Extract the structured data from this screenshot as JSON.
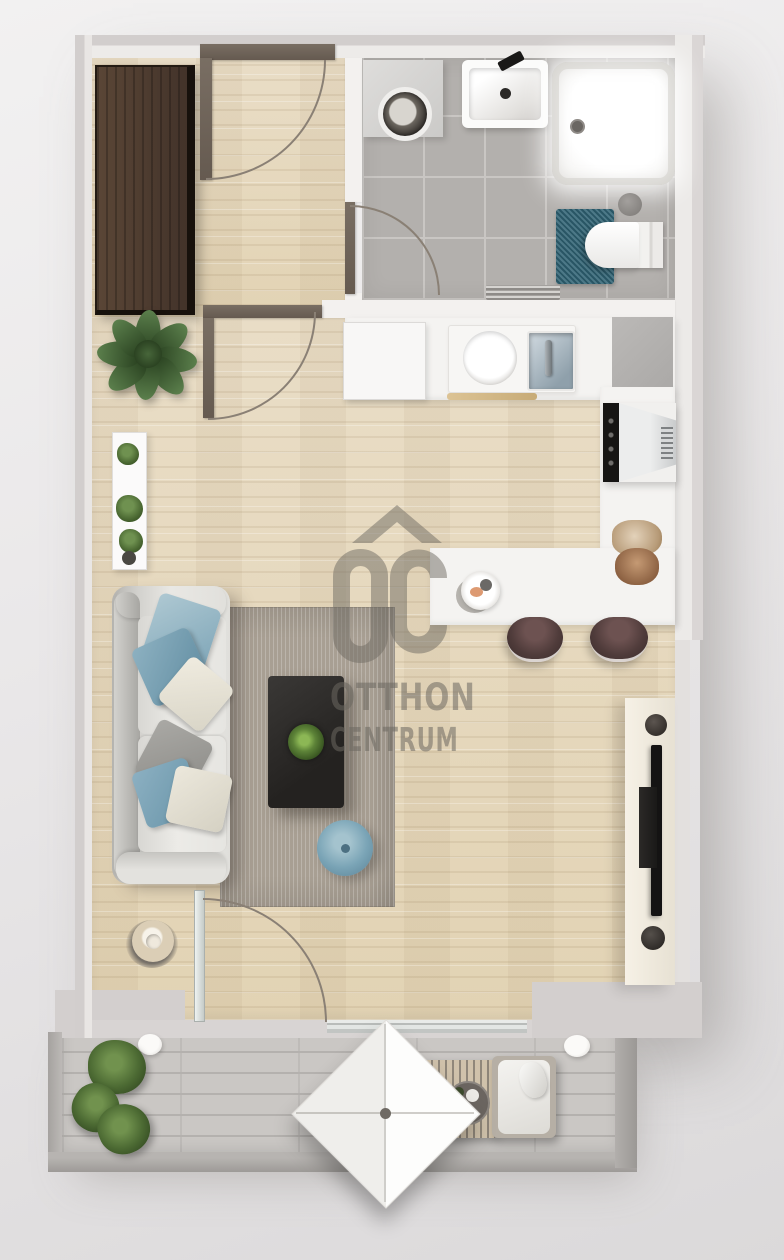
{
  "watermark": {
    "logo": "OC",
    "line1": "OTTHON",
    "line2": "CENTRUM",
    "color": "#6c675f"
  },
  "palette": {
    "background": "#e9e7e8",
    "wall_exterior": "#d3cfce",
    "wall_interior": "#f3f1ef",
    "wood_floor": "#e6d9bf",
    "bathroom_tile": "#b3b0ad",
    "balcony_deck": "#cac7c4",
    "area_rug": "#a89f93",
    "sofa": "#e9e8e4",
    "pillow_blue": "#7fa6b8",
    "pouf_blue": "#7aa4b6",
    "coffee_table": "#2b2927",
    "wardrobe_wood": "#4e3c2f",
    "toilet_rug_teal": "#2f6273",
    "stool_brown": "#503c3b",
    "tv_board_cream": "#f0ebdf",
    "plant_green": "#47642f"
  },
  "scene": {
    "type": "apartment-floor-plan-3d-render",
    "rooms": [
      {
        "name": "hall",
        "floor": "wood",
        "items": [
          "wardrobe",
          "entrance-door"
        ]
      },
      {
        "name": "bathroom",
        "floor": "gray-tile",
        "items": [
          "washing-machine",
          "washbasin",
          "shower-tray",
          "toilet",
          "teal-bath-mat",
          "towel-rail",
          "waste-bin",
          "bathroom-door"
        ]
      },
      {
        "name": "kitchen",
        "floor": "wood",
        "items": [
          "kitchen-counter",
          "sink-with-faucet",
          "round-basin",
          "cutting-board",
          "gray-mat",
          "built-in-appliance",
          "bread-basket",
          "breakfast-bar",
          "plate-with-food",
          "bar-stool-left",
          "bar-stool-right"
        ]
      },
      {
        "name": "living-room",
        "floor": "wood",
        "items": [
          "sofa-with-cushions",
          "area-rug",
          "coffee-table",
          "table-plant",
          "blue-pouf",
          "decor-bowl",
          "tv-board",
          "tv",
          "media-box",
          "large-plant",
          "planter-shelf",
          "interior-door",
          "balcony-door",
          "window"
        ]
      },
      {
        "name": "balcony",
        "floor": "wood-deck",
        "items": [
          "parasol",
          "slatted-table",
          "serving-tray",
          "lounge-chair",
          "potted-plants",
          "deck-lights",
          "parapet"
        ]
      }
    ]
  }
}
